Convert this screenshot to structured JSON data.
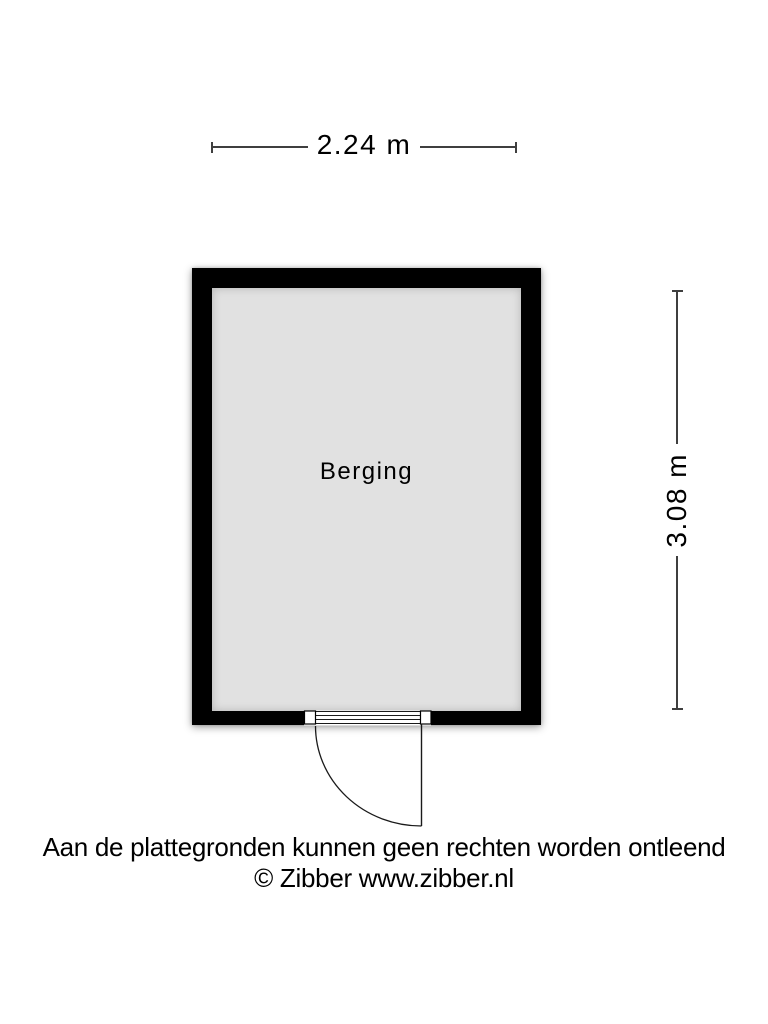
{
  "colors": {
    "background": "#ffffff",
    "wall": "#000000",
    "floor": "#e1e1e1",
    "dimension_line": "#3f3f3f",
    "door_line": "#1a1a1a",
    "text": "#000000"
  },
  "floorplan": {
    "room": {
      "label": "Berging"
    },
    "dimensions": {
      "width": {
        "label": "2.24 m"
      },
      "height": {
        "label": "3.08 m"
      }
    }
  },
  "footer": {
    "disclaimer": "Aan de plattegronden kunnen geen rechten worden ontleend",
    "copyright": "© Zibber www.zibber.nl"
  }
}
